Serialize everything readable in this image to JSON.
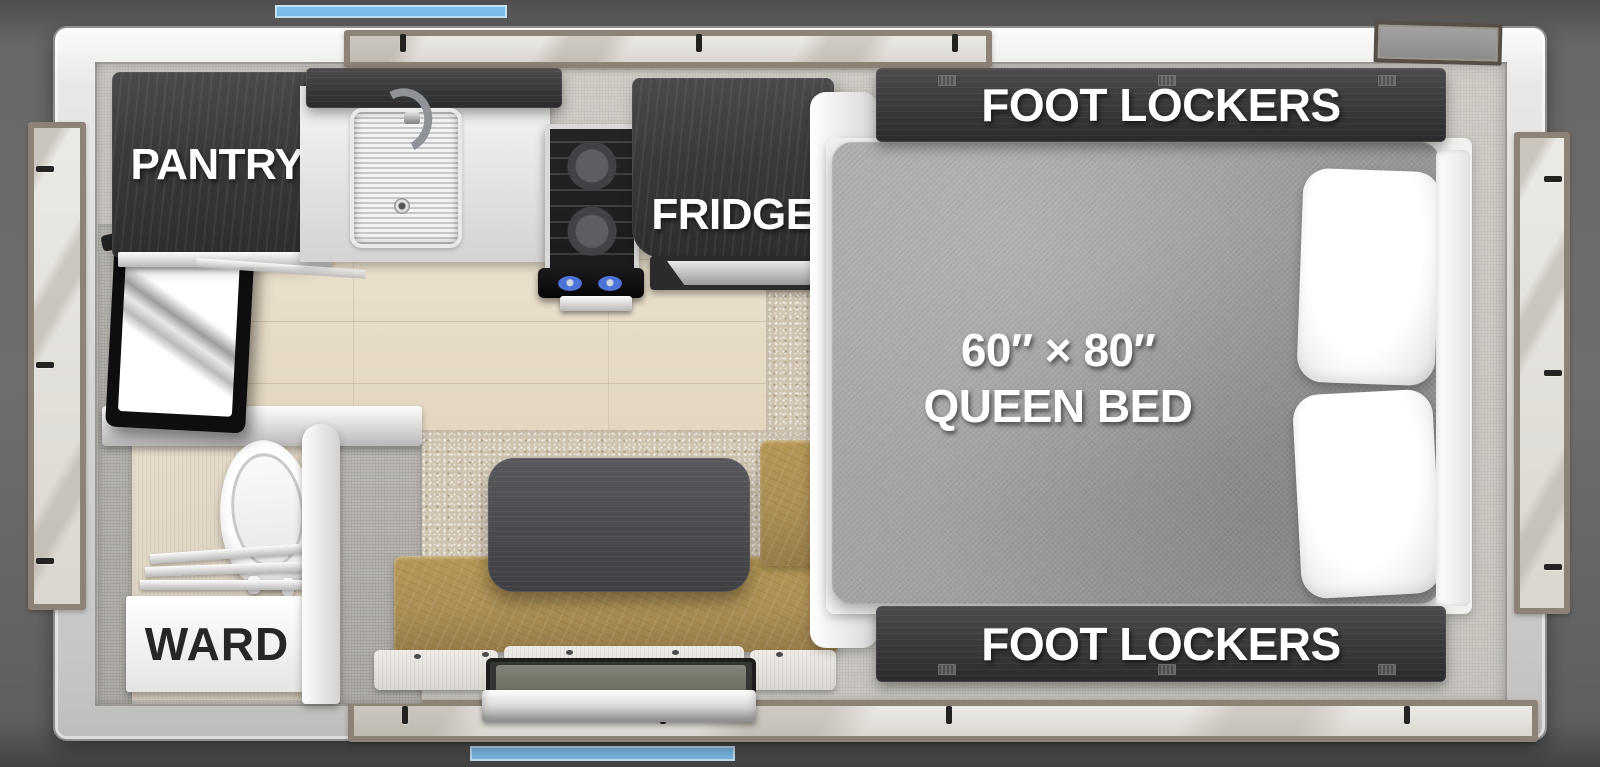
{
  "labels": {
    "pantry": "PANTRY",
    "fridge": "FRIDGE",
    "foot_lockers_top": "FOOT LOCKERS",
    "foot_lockers_bottom": "FOOT LOCKERS",
    "ward": "WARD",
    "bed_line1": "60″ × 80″",
    "bed_line2": "QUEEN BED"
  },
  "colors": {
    "accent_blue": "#7CBDE9",
    "label_white": "#FFFFFF",
    "ward_text": "#262626",
    "cabinet_wood": "#3A3A3C",
    "bench_leather": "#AC8F56",
    "mattress_gray": "#A2A2A2",
    "wood_floor": "#EAE0CC",
    "carpet_tan": "#CFC3B0"
  }
}
